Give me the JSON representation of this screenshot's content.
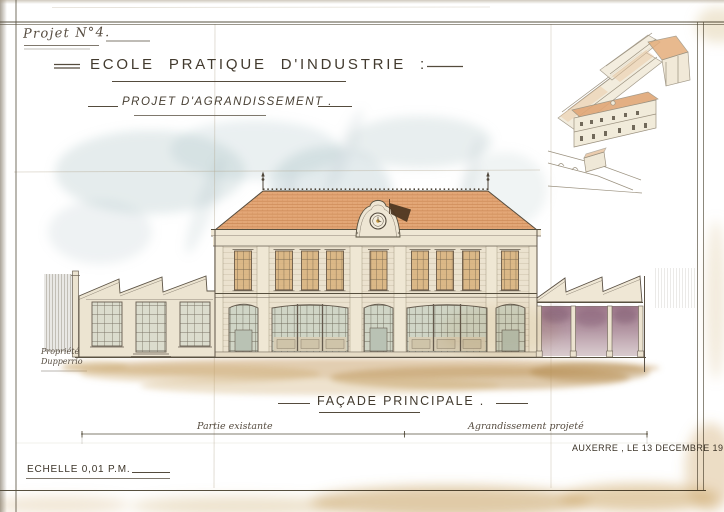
{
  "sheet": {
    "project_number": "Projet N°4.",
    "main_title": "ECOLE PRATIQUE D'INDUSTRIE :",
    "subtitle": "PROJET D'AGRANDISSEMENT .",
    "drawing_caption": "FAÇADE PRINCIPALE .",
    "place_date": "AUXERRE , LE 13 DECEMBRE 1916",
    "scale_note": "ECHELLE 0,01 P.M.",
    "dimension_labels": {
      "existing_part": "Partie existante",
      "extension_part": "Agrandissement projeté"
    },
    "property_note": {
      "line1": "Propriété",
      "line2": "Dupperrio"
    }
  },
  "icons": {
    "clock_dormer": "clock-icon",
    "weathervane": "flag-icon",
    "roof_finials": "finial-icon"
  },
  "colors": {
    "paper": "#eae1cb",
    "ink": "#4f463a",
    "roof_tile_orange": "#e0a470",
    "sky_watercolor_blue": "#a9bfc4",
    "extension_purple_wash": "#9c7186",
    "ground_tan_wash": "#c19a5e",
    "glass_green": "#ccd3c6",
    "upper_window_warm": "#d8b07a"
  }
}
